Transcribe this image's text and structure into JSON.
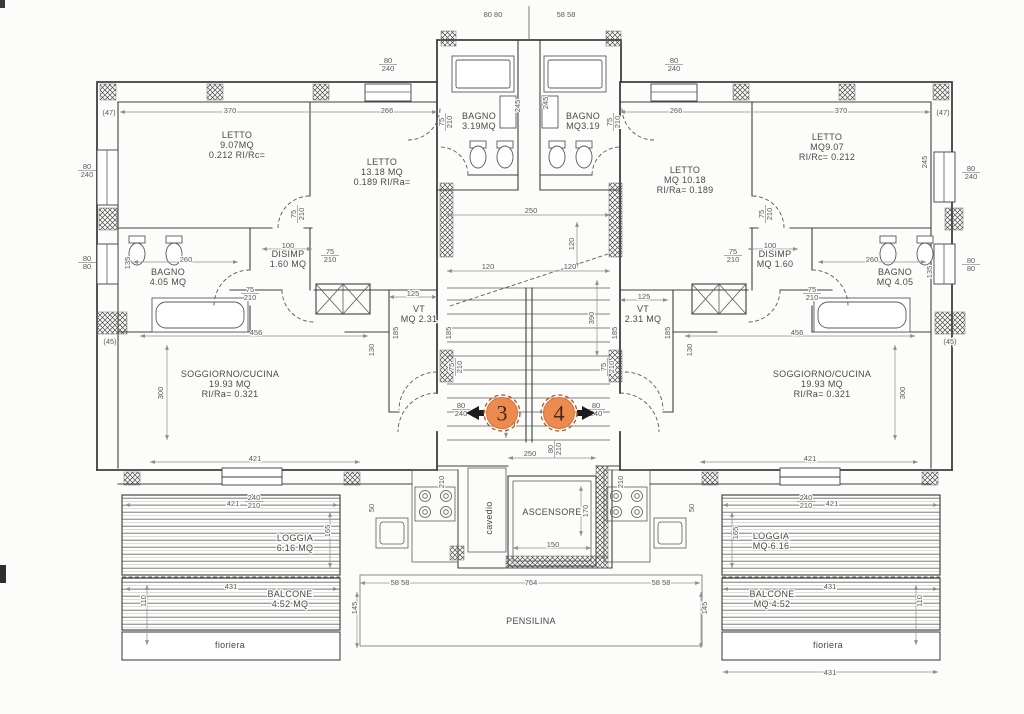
{
  "colors": {
    "bg": "#fcfcfb",
    "line": "#3f3f3f",
    "dim": "#8f8f8f",
    "text": "#4a4a4a",
    "marker_fill": "#ec8a50",
    "marker_stroke": "#b5541f",
    "marker_text": "#472a14"
  },
  "markers": [
    {
      "id": "marker-3",
      "label": "3",
      "cx": 502,
      "cy": 413,
      "dir": "left"
    },
    {
      "id": "marker-4",
      "label": "4",
      "cx": 559,
      "cy": 413,
      "dir": "right"
    }
  ],
  "room_labels": [
    {
      "id": "label-letto-1-sx",
      "x": 237,
      "y": 145,
      "lines": [
        "LETTO",
        "9.07MQ",
        "0.212 RI/Rc="
      ]
    },
    {
      "id": "label-letto-2-sx",
      "x": 382,
      "y": 172,
      "lines": [
        "LETTO",
        "13.18 MQ",
        "0.189 RI/Ra="
      ]
    },
    {
      "id": "label-bagno-top-sx",
      "x": 479,
      "y": 121,
      "lines": [
        "BAGNO",
        "3.19MQ"
      ]
    },
    {
      "id": "label-bagno-top-dx",
      "x": 583,
      "y": 121,
      "lines": [
        "BAGNO",
        "MQ3.19"
      ]
    },
    {
      "id": "label-letto-2-dx",
      "x": 685,
      "y": 180,
      "lines": [
        "LETTO",
        "MQ 10.18",
        "RI/Ra= 0.189"
      ]
    },
    {
      "id": "label-letto-1-dx",
      "x": 827,
      "y": 147,
      "lines": [
        "LETTO",
        "MQ9.07",
        "RI/Rc= 0.212"
      ]
    },
    {
      "id": "label-bagno-sx",
      "x": 168,
      "y": 277,
      "lines": [
        "BAGNO",
        "4.05 MQ"
      ]
    },
    {
      "id": "label-disimp-sx",
      "x": 288,
      "y": 259,
      "lines": [
        "DISIMP",
        "1.60 MQ"
      ]
    },
    {
      "id": "label-disimp-dx",
      "x": 775,
      "y": 259,
      "lines": [
        "DISIMP",
        "MQ 1.60"
      ]
    },
    {
      "id": "label-bagno-dx",
      "x": 895,
      "y": 277,
      "lines": [
        "BAGNO",
        "MQ 4.05"
      ]
    },
    {
      "id": "label-vt-sx",
      "x": 419,
      "y": 314,
      "lines": [
        "VT",
        "MQ 2.31"
      ]
    },
    {
      "id": "label-vt-dx",
      "x": 643,
      "y": 314,
      "lines": [
        "VT",
        "2.31 MQ"
      ]
    },
    {
      "id": "label-soggiorno-sx",
      "x": 230,
      "y": 384,
      "lines": [
        "SOGGIORNO/CUCINA",
        "19.93 MQ",
        "RI/Ra= 0.321"
      ]
    },
    {
      "id": "label-soggiorno-dx",
      "x": 822,
      "y": 384,
      "lines": [
        "SOGGIORNO/CUCINA",
        "19.93 MQ",
        "RI/Ra= 0.321"
      ]
    },
    {
      "id": "label-cavedio",
      "x": 489,
      "y": 518,
      "rot": -90,
      "lines": [
        "cavedio"
      ]
    },
    {
      "id": "label-ascensore",
      "x": 552,
      "y": 512,
      "lines": [
        "ASCENSORE"
      ]
    },
    {
      "id": "label-loggia-sx",
      "x": 295,
      "y": 543,
      "lines": [
        "LOGGIA",
        "6.16 MQ"
      ]
    },
    {
      "id": "label-loggia-dx",
      "x": 771,
      "y": 541,
      "lines": [
        "LOGGIA",
        "MQ 6.16"
      ]
    },
    {
      "id": "label-balcone-sx",
      "x": 290,
      "y": 599,
      "lines": [
        "BALCONE",
        "4.52 MQ"
      ]
    },
    {
      "id": "label-balcone-dx",
      "x": 772,
      "y": 599,
      "lines": [
        "BALCONE",
        "MQ 4.52"
      ]
    },
    {
      "id": "label-fioriera-sx",
      "x": 230,
      "y": 645,
      "lines": [
        "fioriera"
      ]
    },
    {
      "id": "label-fioriera-dx",
      "x": 828,
      "y": 645,
      "lines": [
        "fioriera"
      ]
    },
    {
      "id": "label-pensilina",
      "x": 531,
      "y": 621,
      "lines": [
        "PENSILINA"
      ]
    }
  ],
  "dim_labels": [
    {
      "lines": [
        "(47)"
      ],
      "x": 109,
      "y": 112
    },
    {
      "lines": [
        "370"
      ],
      "x": 230,
      "y": 110
    },
    {
      "lines": [
        "266"
      ],
      "x": 387,
      "y": 110
    },
    {
      "lines": [
        "266"
      ],
      "x": 676,
      "y": 110
    },
    {
      "lines": [
        "370"
      ],
      "x": 841,
      "y": 110
    },
    {
      "lines": [
        "(47)"
      ],
      "x": 943,
      "y": 112
    },
    {
      "lines": [
        "80 80"
      ],
      "x": 493,
      "y": 14
    },
    {
      "lines": [
        "58 58"
      ],
      "x": 566,
      "y": 14
    },
    {
      "lines": [
        "80",
        "240"
      ],
      "x": 388,
      "y": 64,
      "frac": true
    },
    {
      "lines": [
        "80",
        "240"
      ],
      "x": 674,
      "y": 64,
      "frac": true
    },
    {
      "lines": [
        "80",
        "240"
      ],
      "x": 87,
      "y": 170,
      "frac": true
    },
    {
      "lines": [
        "80",
        "80"
      ],
      "x": 87,
      "y": 262,
      "frac": true
    },
    {
      "lines": [
        "(45)"
      ],
      "x": 110,
      "y": 341
    },
    {
      "lines": [
        "80",
        "240"
      ],
      "x": 971,
      "y": 172,
      "frac": true
    },
    {
      "lines": [
        "80",
        "80"
      ],
      "x": 971,
      "y": 264,
      "frac": true
    },
    {
      "lines": [
        "(45)"
      ],
      "x": 950,
      "y": 341
    },
    {
      "lines": [
        "245"
      ],
      "x": 924,
      "y": 162,
      "rot": -90
    },
    {
      "lines": [
        "135"
      ],
      "x": 127,
      "y": 263,
      "rot": -90
    },
    {
      "lines": [
        "135"
      ],
      "x": 929,
      "y": 272,
      "rot": -90
    },
    {
      "lines": [
        "260"
      ],
      "x": 186,
      "y": 259
    },
    {
      "lines": [
        "260"
      ],
      "x": 872,
      "y": 259
    },
    {
      "lines": [
        "100"
      ],
      "x": 288,
      "y": 245
    },
    {
      "lines": [
        "100"
      ],
      "x": 770,
      "y": 245
    },
    {
      "lines": [
        "75",
        "210"
      ],
      "x": 330,
      "y": 255,
      "frac": true
    },
    {
      "lines": [
        "75",
        "210"
      ],
      "x": 733,
      "y": 255,
      "frac": true
    },
    {
      "lines": [
        "75",
        "210"
      ],
      "x": 250,
      "y": 293,
      "frac": true
    },
    {
      "lines": [
        "75",
        "210"
      ],
      "x": 812,
      "y": 293,
      "frac": true
    },
    {
      "lines": [
        "75",
        "210"
      ],
      "x": 297,
      "y": 214,
      "frac": true,
      "rot": -90
    },
    {
      "lines": [
        "75",
        "210"
      ],
      "x": 765,
      "y": 214,
      "frac": true,
      "rot": -90
    },
    {
      "lines": [
        "75",
        "210"
      ],
      "x": 445,
      "y": 122,
      "frac": true,
      "rot": -90
    },
    {
      "lines": [
        "75",
        "210"
      ],
      "x": 613,
      "y": 122,
      "frac": true,
      "rot": -90
    },
    {
      "lines": [
        "245"
      ],
      "x": 517,
      "y": 106,
      "rot": -90
    },
    {
      "lines": [
        "245"
      ],
      "x": 545,
      "y": 103,
      "rot": -90
    },
    {
      "lines": [
        "250"
      ],
      "x": 531,
      "y": 210
    },
    {
      "lines": [
        "120"
      ],
      "x": 571,
      "y": 244,
      "rot": -90
    },
    {
      "lines": [
        "120"
      ],
      "x": 488,
      "y": 266
    },
    {
      "lines": [
        "120"
      ],
      "x": 570,
      "y": 266
    },
    {
      "lines": [
        "390"
      ],
      "x": 591,
      "y": 318,
      "rot": -90
    },
    {
      "lines": [
        "125"
      ],
      "x": 413,
      "y": 293
    },
    {
      "lines": [
        "125"
      ],
      "x": 644,
      "y": 296
    },
    {
      "lines": [
        "185"
      ],
      "x": 395,
      "y": 333,
      "rot": -90
    },
    {
      "lines": [
        "185"
      ],
      "x": 448,
      "y": 333,
      "rot": -90
    },
    {
      "lines": [
        "185"
      ],
      "x": 614,
      "y": 333,
      "rot": -90
    },
    {
      "lines": [
        "185"
      ],
      "x": 667,
      "y": 333,
      "rot": -90
    },
    {
      "lines": [
        "75",
        "210"
      ],
      "x": 455,
      "y": 367,
      "frac": true,
      "rot": -90
    },
    {
      "lines": [
        "75",
        "210"
      ],
      "x": 607,
      "y": 367,
      "frac": true,
      "rot": -90
    },
    {
      "lines": [
        "130"
      ],
      "x": 371,
      "y": 350,
      "rot": -90
    },
    {
      "lines": [
        "130"
      ],
      "x": 689,
      "y": 350,
      "rot": -90
    },
    {
      "lines": [
        "456"
      ],
      "x": 256,
      "y": 332
    },
    {
      "lines": [
        "456"
      ],
      "x": 797,
      "y": 332
    },
    {
      "lines": [
        "300"
      ],
      "x": 160,
      "y": 393,
      "rot": -90
    },
    {
      "lines": [
        "300"
      ],
      "x": 902,
      "y": 393,
      "rot": -90
    },
    {
      "lines": [
        "421"
      ],
      "x": 255,
      "y": 458
    },
    {
      "lines": [
        "421"
      ],
      "x": 810,
      "y": 458
    },
    {
      "lines": [
        "80",
        "240"
      ],
      "x": 461,
      "y": 409,
      "frac": true
    },
    {
      "lines": [
        "80",
        "240"
      ],
      "x": 596,
      "y": 409,
      "frac": true
    },
    {
      "lines": [
        "150"
      ],
      "x": 512,
      "y": 420,
      "rot": -90
    },
    {
      "lines": [
        "250"
      ],
      "x": 530,
      "y": 453
    },
    {
      "lines": [
        "80",
        "210"
      ],
      "x": 554,
      "y": 449,
      "frac": true,
      "rot": -90
    },
    {
      "lines": [
        "210"
      ],
      "x": 441,
      "y": 482,
      "rot": -90
    },
    {
      "lines": [
        "210"
      ],
      "x": 620,
      "y": 482,
      "rot": -90
    },
    {
      "lines": [
        "170"
      ],
      "x": 585,
      "y": 511,
      "rot": -90
    },
    {
      "lines": [
        "150"
      ],
      "x": 553,
      "y": 544
    },
    {
      "lines": [
        "50"
      ],
      "x": 371,
      "y": 508,
      "rot": -90
    },
    {
      "lines": [
        "50"
      ],
      "x": 691,
      "y": 508,
      "rot": -90
    },
    {
      "lines": [
        "421"
      ],
      "x": 233,
      "y": 503
    },
    {
      "lines": [
        "421"
      ],
      "x": 832,
      "y": 503
    },
    {
      "lines": [
        "240",
        "210"
      ],
      "x": 254,
      "y": 501,
      "frac": true
    },
    {
      "lines": [
        "240",
        "210"
      ],
      "x": 806,
      "y": 501,
      "frac": true
    },
    {
      "lines": [
        "165"
      ],
      "x": 327,
      "y": 531,
      "rot": -90
    },
    {
      "lines": [
        "165"
      ],
      "x": 735,
      "y": 533,
      "rot": -90
    },
    {
      "lines": [
        "431"
      ],
      "x": 231,
      "y": 586
    },
    {
      "lines": [
        "431"
      ],
      "x": 830,
      "y": 586
    },
    {
      "lines": [
        "110"
      ],
      "x": 143,
      "y": 601,
      "rot": -90
    },
    {
      "lines": [
        "110"
      ],
      "x": 919,
      "y": 601,
      "rot": -90
    },
    {
      "lines": [
        "145"
      ],
      "x": 354,
      "y": 608,
      "rot": -90
    },
    {
      "lines": [
        "145"
      ],
      "x": 704,
      "y": 608,
      "rot": -90
    },
    {
      "lines": [
        "58 58"
      ],
      "x": 400,
      "y": 582
    },
    {
      "lines": [
        "764"
      ],
      "x": 531,
      "y": 582
    },
    {
      "lines": [
        "58 58"
      ],
      "x": 661,
      "y": 582
    },
    {
      "lines": [
        "431"
      ],
      "x": 830,
      "y": 672
    }
  ]
}
